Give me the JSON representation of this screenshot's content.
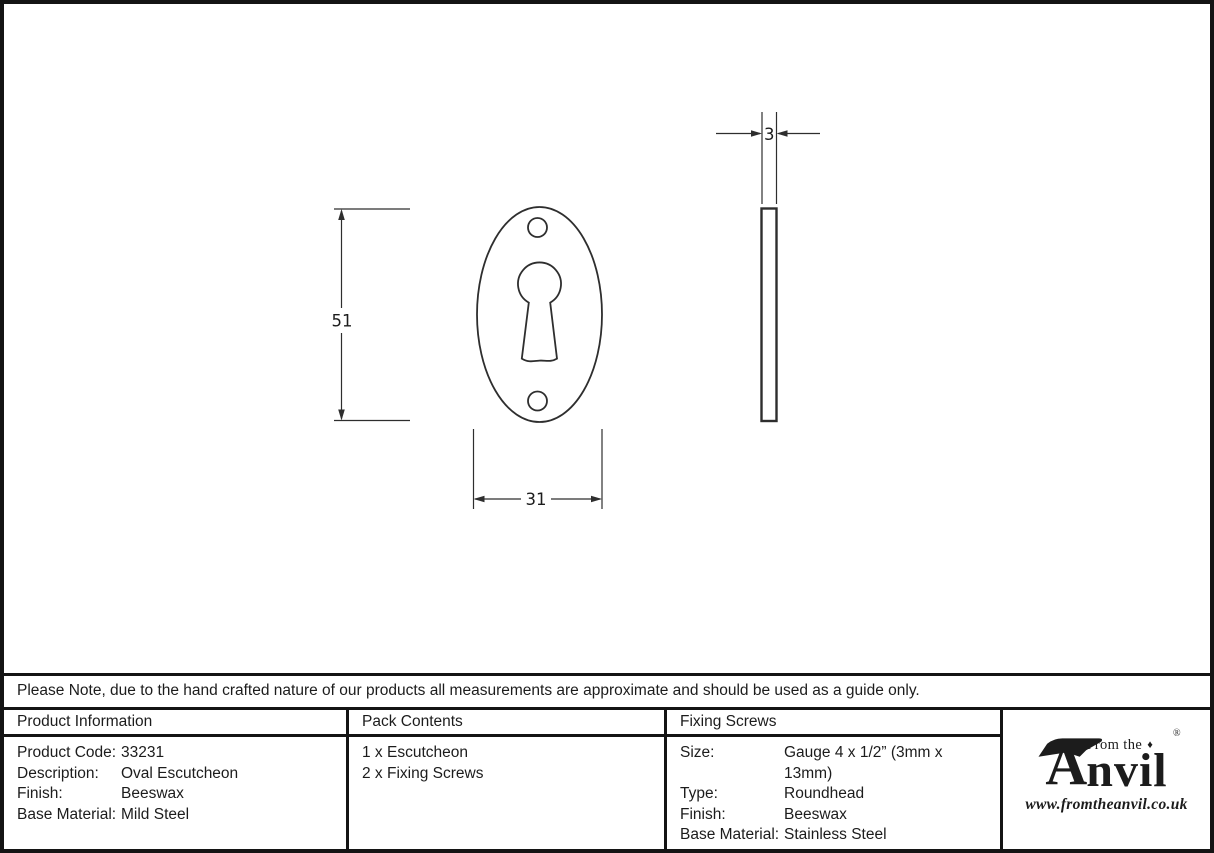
{
  "note": "Please Note, due to the hand crafted nature of our products all measurements are approximate and should be used as a guide only.",
  "drawing": {
    "height_label": "51",
    "width_label": "31",
    "thickness_label": "3"
  },
  "table": {
    "product_information": {
      "header": "Product Information",
      "rows": [
        {
          "label": "Product Code:",
          "value": "33231"
        },
        {
          "label": "Description:",
          "value": "Oval Escutcheon"
        },
        {
          "label": "Finish:",
          "value": "Beeswax"
        },
        {
          "label": "Base Material:",
          "value": "Mild Steel"
        }
      ]
    },
    "pack_contents": {
      "header": "Pack Contents",
      "items": [
        "1 x Escutcheon",
        "2 x Fixing Screws"
      ]
    },
    "fixing_screws": {
      "header": "Fixing Screws",
      "rows": [
        {
          "label": "Size:",
          "value": "Gauge 4 x 1/2” (3mm x 13mm)"
        },
        {
          "label": "Type:",
          "value": "Roundhead"
        },
        {
          "label": "Finish:",
          "value": "Beeswax"
        },
        {
          "label": "Base Material:",
          "value": "Stainless Steel"
        }
      ]
    }
  },
  "logo": {
    "prefix": "From the",
    "name_initial": "A",
    "name_rest": "nvil",
    "registered": "®",
    "url": "www.fromtheanvil.co.uk"
  },
  "colors": {
    "ink": "#1c1c1c",
    "line": "#2e2e2e",
    "border": "#141414",
    "background": "#ffffff"
  }
}
